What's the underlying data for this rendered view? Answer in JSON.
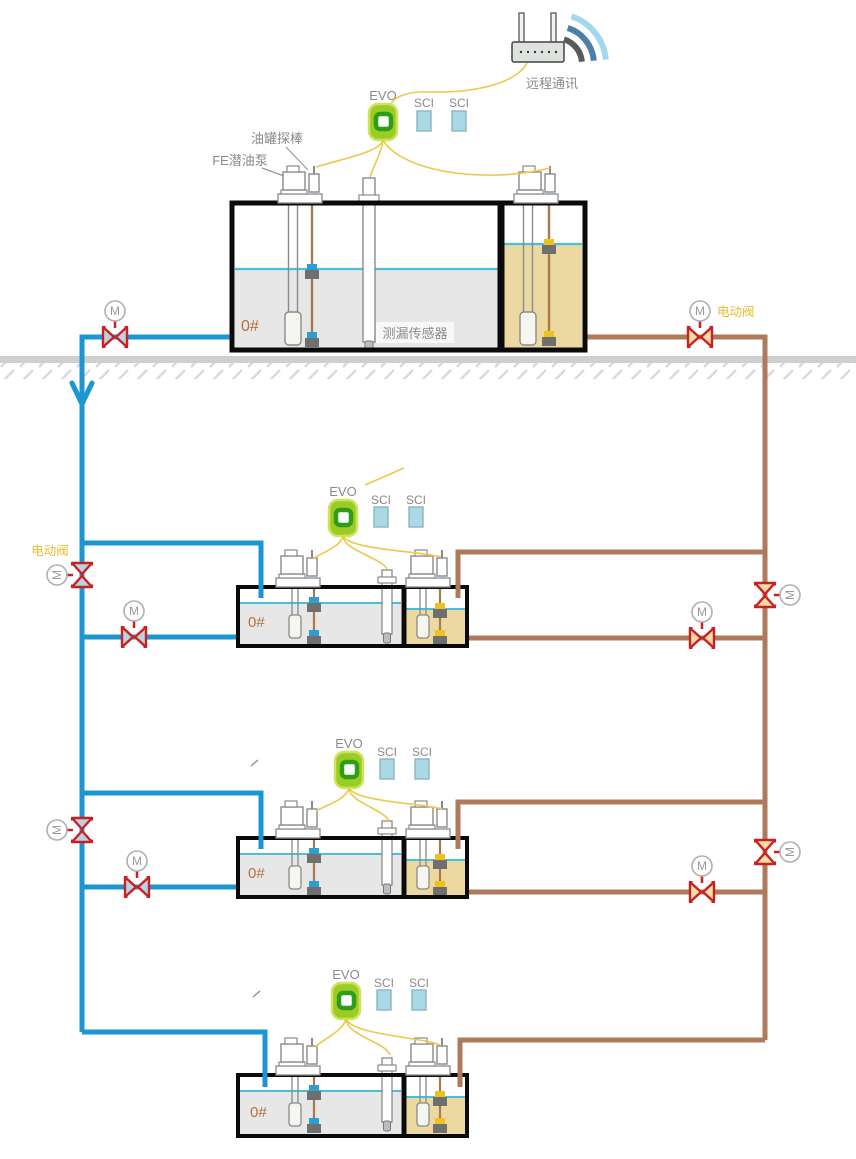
{
  "diagram": {
    "labels": {
      "remote_comm": "远程通讯",
      "evo": "EVO",
      "sci": "SCI",
      "motor": "M",
      "tank_probe": "油罐探棒",
      "submersible_pump": "FE潜油泵",
      "leak_sensor": "测漏传感器",
      "electric_valve": "电动阀",
      "fuel_grade": "0#"
    },
    "colors": {
      "diesel_pipe": "#1b96d2",
      "gasoline_pipe": "#ad7a5c",
      "valve_red": "#c92121",
      "signal_wire": "#ecc94b",
      "evo_green": "#9bcc25",
      "sci_blue": "#a9d8e6",
      "diesel_liquid": "#e7e7e7",
      "gasoline_liquid": "#ecd9a2",
      "liquid_surface": "#49c0d8",
      "label_gray": "#8a8a8a",
      "accent_orange": "#e9bd2d"
    }
  }
}
